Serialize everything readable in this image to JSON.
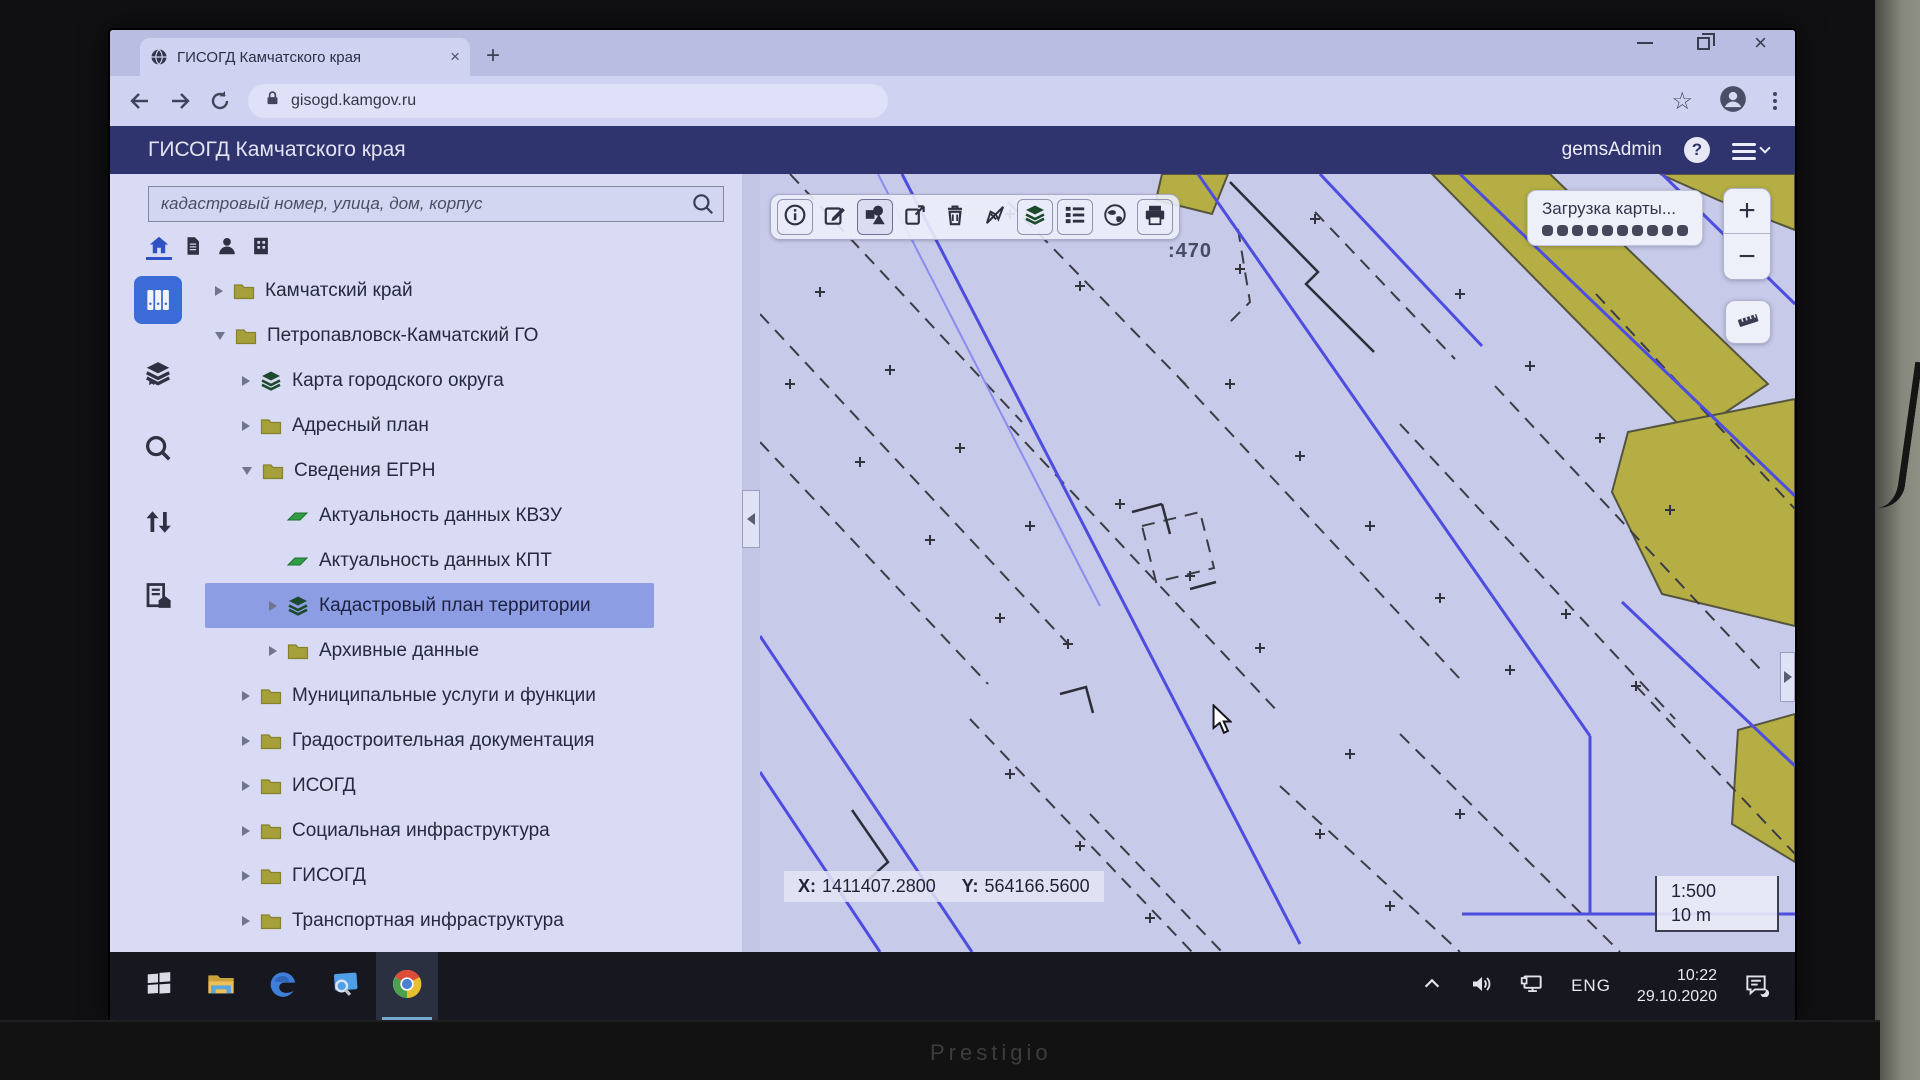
{
  "screen": {
    "brand": "Prestigio"
  },
  "browser": {
    "tab": {
      "title": "ГИСОГД Камчатского края",
      "close_glyph": "×",
      "new_tab_glyph": "+"
    },
    "address": {
      "url": "gisogd.kamgov.ru"
    }
  },
  "app_header": {
    "title": "ГИСОГД Камчатского края",
    "user": "gemsAdmin"
  },
  "sidebar": {
    "search_placeholder": "кадастровый номер, улица, дом, корпус",
    "mini_icons": [
      "home",
      "document",
      "person",
      "building"
    ],
    "rail_icons": [
      "binders",
      "books",
      "search",
      "transfer-arrows",
      "document-home"
    ],
    "tree": [
      {
        "label": "Камчатский край",
        "icon": "folder",
        "expander": "right",
        "level": 0,
        "selected": false
      },
      {
        "label": "Петропавловск-Камчатский ГО",
        "icon": "folder",
        "expander": "down",
        "level": 0,
        "selected": false
      },
      {
        "label": "Карта городского округа",
        "icon": "layers",
        "expander": "right",
        "level": 1,
        "selected": false
      },
      {
        "label": "Адресный план",
        "icon": "folder",
        "expander": "right",
        "level": 1,
        "selected": false
      },
      {
        "label": "Сведения ЕГРН",
        "icon": "folder",
        "expander": "down",
        "level": 1,
        "selected": false
      },
      {
        "label": "Актуальность данных КВЗУ",
        "icon": "flag",
        "expander": "none",
        "level": 2,
        "selected": false
      },
      {
        "label": "Актуальность данных КПТ",
        "icon": "flag",
        "expander": "none",
        "level": 2,
        "selected": false
      },
      {
        "label": "Кадастровый план территории",
        "icon": "layers",
        "expander": "right",
        "level": 2,
        "selected": true
      },
      {
        "label": "Архивные данные",
        "icon": "folder",
        "expander": "right",
        "level": 2,
        "selected": false
      },
      {
        "label": "Муниципальные услуги и функции",
        "icon": "folder",
        "expander": "right",
        "level": 1,
        "selected": false
      },
      {
        "label": "Градостроительная документация",
        "icon": "folder",
        "expander": "right",
        "level": 1,
        "selected": false
      },
      {
        "label": "ИСОГД",
        "icon": "folder",
        "expander": "right",
        "level": 1,
        "selected": false
      },
      {
        "label": "Социальная инфраструктура",
        "icon": "folder",
        "expander": "right",
        "level": 1,
        "selected": false
      },
      {
        "label": "ГИСОГД",
        "icon": "folder",
        "expander": "right",
        "level": 1,
        "selected": false
      },
      {
        "label": "Транспортная инфраструктура",
        "icon": "folder",
        "expander": "right",
        "level": 1,
        "selected": false
      }
    ]
  },
  "map": {
    "toolbar": [
      "info",
      "edit",
      "draw-shapes",
      "open-external",
      "trash",
      "measure-arrow",
      "layers",
      "legend-list",
      "globe",
      "print"
    ],
    "toolbar_active": "draw-shapes",
    "loading_text": "Загрузка карты...",
    "loading_dots": 10,
    "parcel_label": ":470",
    "zoom_in": "+",
    "zoom_out": "−",
    "coords": {
      "x_label": "X:",
      "x_value": "1411407.2800",
      "y_label": "Y:",
      "y_value": "564166.5600"
    },
    "scale": {
      "ratio": "1:500",
      "bar_length": "10 m"
    }
  },
  "taskbar": {
    "apps": [
      "start-windows",
      "file-explorer",
      "edge",
      "screen-search",
      "chrome"
    ],
    "active_app": "chrome",
    "tray_icons": [
      "chevron-up",
      "speaker",
      "network"
    ],
    "lang": "ENG",
    "time": "10:22",
    "date": "29.10.2020",
    "action_icon": "action-center"
  }
}
